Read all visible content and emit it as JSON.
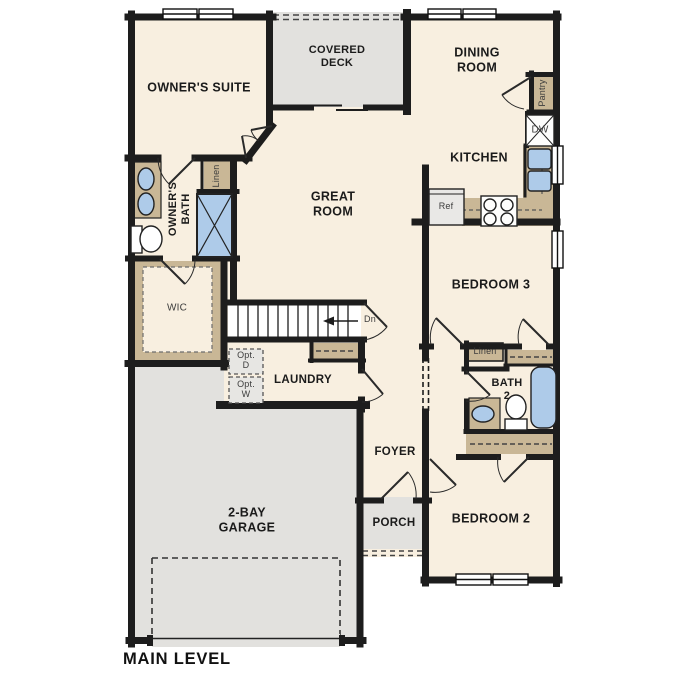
{
  "plan": {
    "title": "MAIN LEVEL"
  },
  "rooms": {
    "owners_suite": {
      "label": "OWNER'S SUITE"
    },
    "covered_deck": {
      "label": "COVERED DECK"
    },
    "dining_room": {
      "label": "DINING ROOM"
    },
    "kitchen": {
      "label": "KITCHEN"
    },
    "great_room": {
      "label": "GREAT ROOM"
    },
    "owners_bath": {
      "label": "OWNER'S BATH"
    },
    "wic": {
      "label": "WIC"
    },
    "laundry": {
      "label": "LAUNDRY"
    },
    "foyer": {
      "label": "FOYER"
    },
    "porch": {
      "label": "PORCH"
    },
    "garage": {
      "label": "2-BAY GARAGE"
    },
    "bedroom3": {
      "label": "BEDROOM 3"
    },
    "bath2": {
      "label": "BATH 2"
    },
    "bedroom2": {
      "label": "BEDROOM 2"
    }
  },
  "closets": {
    "linen_owners": "Linen",
    "linen_hall": "Linen",
    "pantry": "Pantry"
  },
  "appliances": {
    "refrigerator": "Ref",
    "dishwasher": "DW",
    "optional_dryer": "Opt. D",
    "optional_washer": "Opt. W"
  },
  "stairs": {
    "direction_label": "Dn"
  },
  "colors": {
    "floor": "#f8efe0",
    "outdoor_gray": "#e2e1de",
    "casework_tan": "#c9b796",
    "fixture_blue": "#aecbe9",
    "wall_black": "#1d1d1d"
  }
}
